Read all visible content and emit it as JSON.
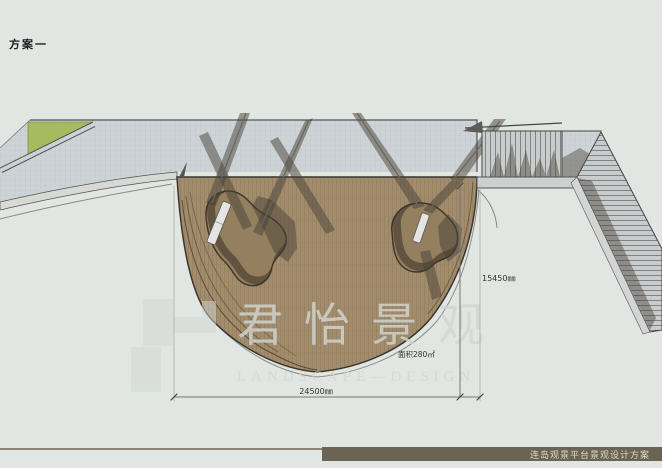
{
  "page": {
    "title": "方案一"
  },
  "plan": {
    "area_label": "面积280㎡",
    "dim_width": "24500㎜",
    "dim_height": "15450㎜"
  },
  "watermark": {
    "cn": "君怡景观",
    "en": "LANDSCAPE—DESIGN"
  },
  "footer": {
    "title": "连岛观景平台景观设计方案"
  },
  "colors": {
    "background": "#e1e6e2",
    "paving": "#cdd3d6",
    "paving_grid": "#bcc5c8",
    "lawn": "#a6ba60",
    "deck_wood": "#a28c6b",
    "deck_plank_line": "#7e6c52",
    "curb": "#d7d9d5",
    "stair_tread": "#c8cccc",
    "shadow": "#48423a",
    "footer_bar": "#6b6353",
    "footer_text": "#ded9c8",
    "watermark": "#d2d7d3",
    "dim_line": "#777777",
    "label_text": "#333333"
  }
}
